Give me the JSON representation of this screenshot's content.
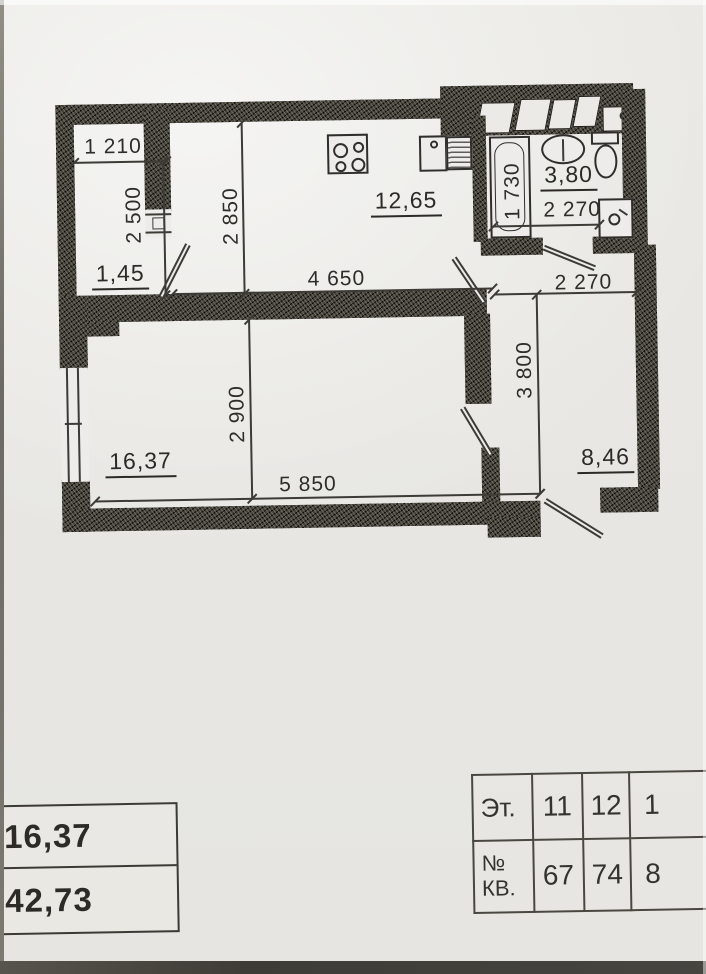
{
  "floor_plan": {
    "loggia": {
      "width": "1 210",
      "depth": "2 500",
      "area": "1,45"
    },
    "kitchen": {
      "depth": "2 850",
      "width": "4 650",
      "area": "12,65"
    },
    "bathroom": {
      "tub_length": "1 730",
      "area": "3,80",
      "width": "2 270"
    },
    "hall": {
      "width": "2 270",
      "depth": "3 800",
      "area": "8,46"
    },
    "living_room": {
      "depth": "2 900",
      "width": "5 850",
      "area": "16,37"
    }
  },
  "area_summary_table": {
    "rows": [
      {
        "value": "16,37"
      },
      {
        "value": "42,73"
      }
    ]
  },
  "apartment_table": {
    "floor_row": {
      "header": "Эт.",
      "values": [
        "11",
        "12",
        "1"
      ]
    },
    "apartment_row": {
      "header_line1": "№",
      "header_line2": "КВ.",
      "values": [
        "67",
        "74",
        "8"
      ]
    }
  }
}
